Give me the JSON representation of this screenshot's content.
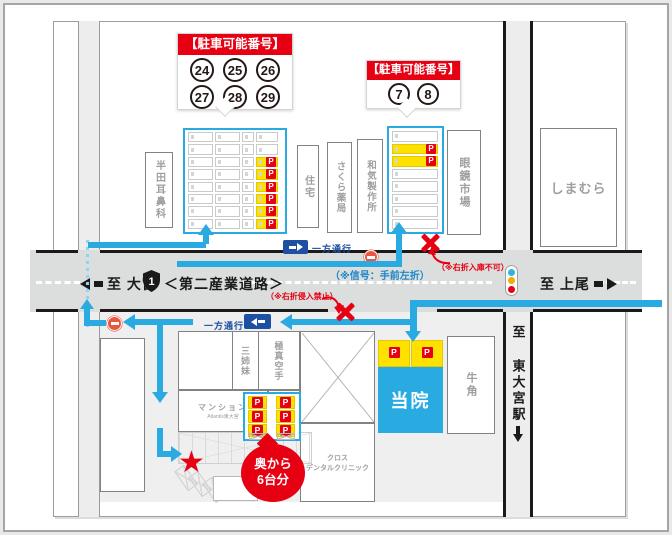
{
  "p_label": "P",
  "icons": {
    "star": "★"
  },
  "colors": {
    "route_blue": "#29abe2",
    "sign_blue": "#1d50a2",
    "red": "#e60012",
    "yellow": "#ffe100",
    "road_gray": "#dcdddd",
    "clinic_blue": "#29abe2"
  },
  "bubble_left": {
    "title": "【駐車可能番号】",
    "row1": [
      "24",
      "25",
      "26"
    ],
    "row2": [
      "27",
      "28",
      "29"
    ]
  },
  "bubble_right": {
    "title": "【駐車可能番号】",
    "numbers": [
      "7",
      "8"
    ]
  },
  "lots": {
    "north_west": {
      "gap": 2,
      "columns": [
        {
          "w": 25,
          "stalls": 8,
          "p": []
        },
        {
          "w": 25,
          "stalls": 8,
          "p": []
        },
        {
          "w": 12,
          "stalls": 8,
          "p": []
        },
        {
          "w": 22,
          "stalls": 8,
          "p": [
            3,
            4,
            5,
            6,
            7,
            8
          ]
        }
      ]
    },
    "north_east": {
      "gap": 2,
      "columns": [
        {
          "w": 46,
          "stalls": 8,
          "p": [
            2,
            3
          ]
        }
      ]
    },
    "clinic_back": {
      "gap": 9,
      "columns": [
        {
          "w": 19,
          "stalls": 3,
          "p": [
            1,
            2,
            3
          ]
        },
        {
          "w": 19,
          "stalls": 3,
          "p": [
            1,
            2,
            3
          ]
        }
      ]
    }
  },
  "buildings": {
    "handa": "半田耳鼻科",
    "jutaku": "住宅",
    "sakura": "さくら薬局",
    "waki": "和気製作所",
    "megane": "眼鏡市場",
    "shimamura": "しまむら",
    "sanshimai": "三姉妹",
    "kyokushin": "極真空手",
    "mansion": "マンション",
    "mansion_sub": "Atlantis東大宮",
    "cross_line1": "クロス",
    "cross_line2": "デンタルクリニック",
    "gyukaku": "牛角",
    "clinic": "当院"
  },
  "road": {
    "to_omiya": "至 大宮",
    "route_shield": "1",
    "name": "＜第二産業道路＞",
    "to_ageo": "至 上尾",
    "to_station": "至 東大宮駅"
  },
  "notes": {
    "one_way": "一方通行",
    "signal": "（※信号：手前左折）",
    "no_right_entry": "（※右折入庫不可）",
    "no_right_turn": "（※右折侵入禁止）"
  },
  "back_bubble": {
    "line1": "奥から",
    "line2": "6台分"
  }
}
